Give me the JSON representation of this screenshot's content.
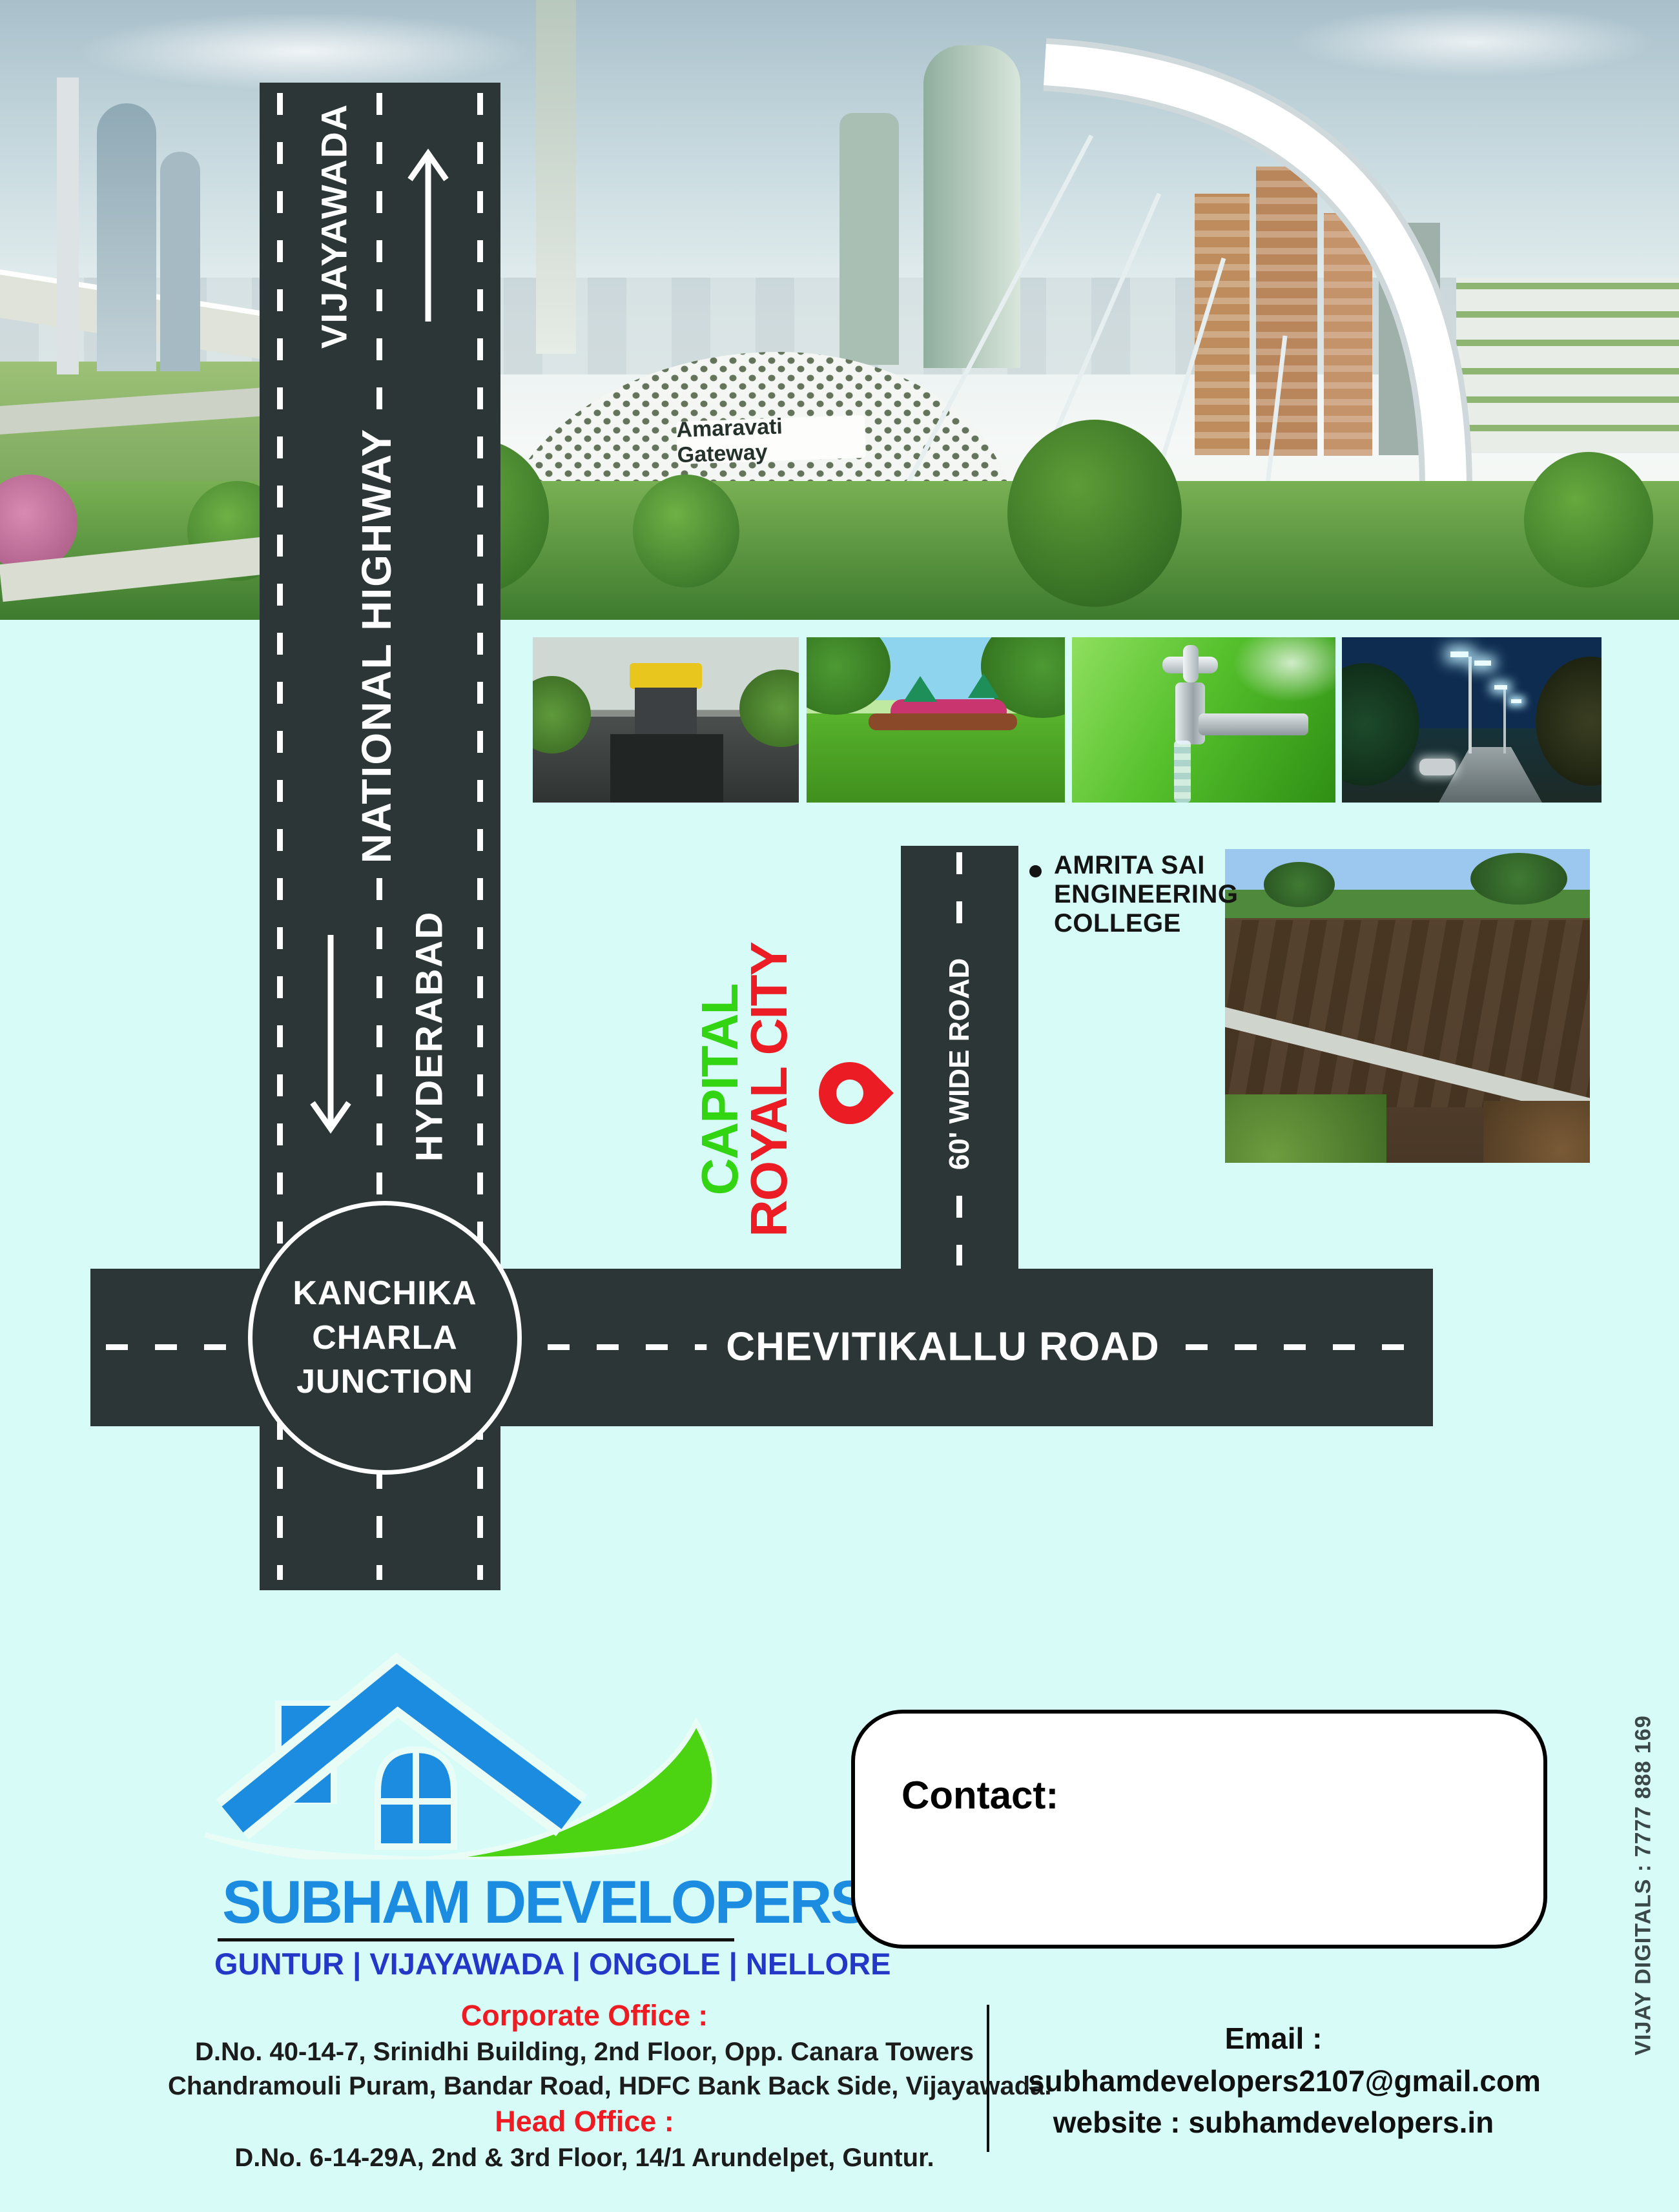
{
  "banner": {
    "sign": "Amaravati Gateway"
  },
  "map": {
    "national_highway": {
      "city_top": "VIJAYAWADA",
      "name": "NATIONAL HIGHWAY",
      "city_bottom": "HYDERABAD"
    },
    "junction": {
      "line1": "KANCHIKA",
      "line2": "CHARLA",
      "line3": "JUNCTION"
    },
    "cross_road": {
      "name": "CHEVITIKALLU ROAD"
    },
    "wide_road": {
      "name": "60' WIDE ROAD"
    },
    "site": {
      "name_line1": "CAPITAL",
      "name_line2": "ROYAL CITY"
    },
    "landmark": {
      "line1": "AMRITA SAI",
      "line2": "ENGINEERING",
      "line3": "COLLEGE"
    }
  },
  "brand": {
    "company": "SUBHAM DEVELOPERS",
    "cities": "GUNTUR | VIJAYAWADA | ONGOLE | NELLORE"
  },
  "contact": {
    "title": "Contact:"
  },
  "offices": {
    "corporate_label": "Corporate Office :",
    "corporate_line1": "D.No. 40-14-7, Srinidhi Building, 2nd Floor, Opp. Canara Towers",
    "corporate_line2": "Chandramouli Puram, Bandar Road, HDFC Bank Back Side, Vijayawada.",
    "head_label": "Head Office :",
    "head_line1": "D.No. 6-14-29A, 2nd & 3rd Floor, 14/1 Arundelpet, Guntur."
  },
  "reach": {
    "email_label": "Email :",
    "email": "subhamdevelopers2107@gmail.com",
    "website": "website : subhamdevelopers.in"
  },
  "credit": {
    "printer": "VIJAY DIGITALS : 7777 888 169"
  },
  "colors": {
    "background": "#d7fcf8",
    "road": "#2c3636",
    "site_green": "#33d411",
    "site_red": "#ec1c24",
    "brand_blue": "#1b8ce0",
    "cities_blue": "#2438c8",
    "office_red": "#ee1b23"
  }
}
